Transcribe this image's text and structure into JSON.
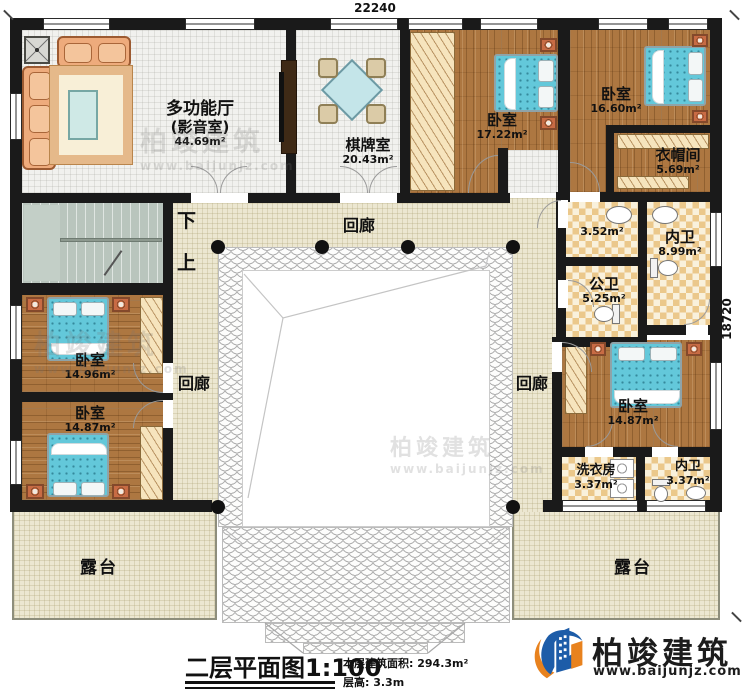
{
  "dimensions": {
    "top": "22240",
    "right": "18720"
  },
  "rooms": {
    "media": {
      "name": "多功能厅",
      "sub": "(影音室)",
      "area": "44.69m²"
    },
    "chess": {
      "name": "棋牌室",
      "area": "20.43m²"
    },
    "bed_a": {
      "name": "卧室",
      "area": "17.22m²"
    },
    "bed_b": {
      "name": "卧室",
      "area": "16.60m²"
    },
    "cloak": {
      "name": "衣帽间",
      "area": "5.69m²"
    },
    "vanity": {
      "area": "3.52m²"
    },
    "bath_master": {
      "name": "内卫",
      "area": "8.99m²"
    },
    "bath_public": {
      "name": "公卫",
      "area": "5.25m²"
    },
    "bed_c": {
      "name": "卧室",
      "area": "14.96m²"
    },
    "bed_d": {
      "name": "卧室",
      "area": "14.87m²"
    },
    "bed_e": {
      "name": "卧室",
      "area": "14.87m²"
    },
    "laundry": {
      "name": "洗衣房",
      "area": "3.37m²"
    },
    "bath_small": {
      "name": "内卫",
      "area": "3.37m²"
    }
  },
  "corridors": {
    "top": "回廊",
    "left": "回廊",
    "right": "回廊"
  },
  "terraces": {
    "left": "露台",
    "right": "露台"
  },
  "stairs": {
    "down": "下",
    "up": "上"
  },
  "titleblock": {
    "title": "二层平面图",
    "scale": "1:100",
    "floor_area": "本层建筑面积: 294.3m²",
    "floor_height": "层高: 3.3m"
  },
  "brand": {
    "name": "柏竣建筑",
    "site": "www.baijunjz.com"
  },
  "watermark": {
    "name": "柏竣建筑",
    "site": "www.baijunjz.com"
  },
  "colors": {
    "wall": "#1a1a1a",
    "wood": "#ad7741",
    "bed": "#63c8da",
    "logo_blue": "#1d5ca8",
    "logo_orange": "#e8821e"
  }
}
